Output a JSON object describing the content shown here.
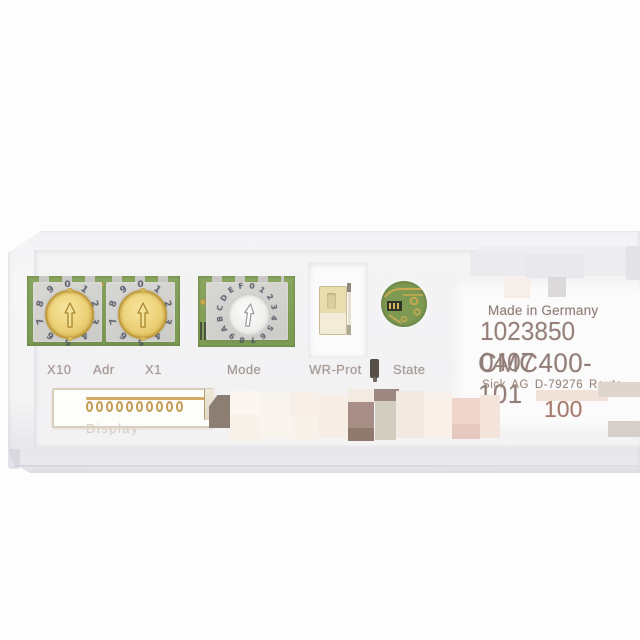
{
  "label": {
    "made_in": "Made in Germany",
    "order_number": "1023850 0407",
    "model": "CMC400-101",
    "manufacturer_line": "Sick AG  D-79276 Reute",
    "partial_bottom": "100"
  },
  "panel_labels": {
    "x10": "X10",
    "adr": "Adr",
    "x1": "X1",
    "mode": "Mode",
    "wr_prot": "WR-Prot",
    "state": "State",
    "display": "Display"
  },
  "switches": {
    "address_tens": {
      "type": "rotary-decimal",
      "digits": [
        "0",
        "1",
        "2",
        "3",
        "4",
        "5",
        "6",
        "7",
        "8",
        "9"
      ]
    },
    "address_ones": {
      "type": "rotary-decimal",
      "digits": [
        "0",
        "1",
        "2",
        "3",
        "4",
        "5",
        "6",
        "7",
        "8",
        "9"
      ]
    },
    "mode": {
      "type": "rotary-hex",
      "digits": [
        "0",
        "1",
        "2",
        "3",
        "4",
        "5",
        "6",
        "7",
        "8",
        "9",
        "A",
        "B",
        "C",
        "D",
        "E",
        "F"
      ]
    },
    "write_protect": {
      "type": "slide-switch"
    }
  },
  "connector": {
    "pins": 10
  },
  "colors": {
    "pcb_green": "#7e9c54",
    "dial_yellow": "#ecd077",
    "gold": "#c9a94f",
    "silkscreen_text": "#a29690",
    "label_text": "#927e78",
    "housing": "#f4f4f5"
  },
  "redactions": [
    {
      "x": 478,
      "y": 246,
      "w": 162,
      "h": 16,
      "c": "#eeeef1"
    },
    {
      "x": 470,
      "y": 252,
      "w": 56,
      "h": 24,
      "c": "#ebebee"
    },
    {
      "x": 526,
      "y": 254,
      "w": 58,
      "h": 24,
      "c": "#e9e9ed"
    },
    {
      "x": 584,
      "y": 250,
      "w": 56,
      "h": 26,
      "c": "#ececef"
    },
    {
      "x": 626,
      "y": 246,
      "w": 14,
      "h": 34,
      "c": "#e3e3e8"
    },
    {
      "x": 504,
      "y": 278,
      "w": 26,
      "h": 20,
      "c": "#f6eee8"
    },
    {
      "x": 548,
      "y": 277,
      "w": 18,
      "h": 20,
      "c": "#dcd9da"
    },
    {
      "x": 209,
      "y": 395,
      "w": 21,
      "h": 33,
      "c": "#8d7e74",
      "clip": "polygon(40% 0,100% 0,100% 100%,0 100%,0 35%)"
    },
    {
      "x": 230,
      "y": 391,
      "w": 30,
      "h": 24,
      "c": "#fbf6f0"
    },
    {
      "x": 230,
      "y": 415,
      "w": 30,
      "h": 26,
      "c": "#f8f1e9"
    },
    {
      "x": 260,
      "y": 393,
      "w": 30,
      "h": 45,
      "c": "#faf4ee"
    },
    {
      "x": 290,
      "y": 391,
      "w": 29,
      "h": 25,
      "c": "#f7efe7"
    },
    {
      "x": 290,
      "y": 416,
      "w": 29,
      "h": 24,
      "c": "#f9f2ea"
    },
    {
      "x": 319,
      "y": 395,
      "w": 29,
      "h": 43,
      "c": "#f6ede5"
    },
    {
      "x": 348,
      "y": 389,
      "w": 27,
      "h": 13,
      "c": "#f3ebe2"
    },
    {
      "x": 348,
      "y": 402,
      "w": 26,
      "h": 26,
      "c": "#a78f87"
    },
    {
      "x": 348,
      "y": 428,
      "w": 26,
      "h": 13,
      "c": "#8f7a6d"
    },
    {
      "x": 374,
      "y": 389,
      "w": 25,
      "h": 12,
      "c": "#9c8880"
    },
    {
      "x": 375,
      "y": 401,
      "w": 21,
      "h": 39,
      "c": "#d3ccc1"
    },
    {
      "x": 396,
      "y": 391,
      "w": 28,
      "h": 47,
      "c": "#f2eae1"
    },
    {
      "x": 424,
      "y": 393,
      "w": 28,
      "h": 45,
      "c": "#f8f0e9"
    },
    {
      "x": 452,
      "y": 398,
      "w": 28,
      "h": 26,
      "c": "#eed6cd"
    },
    {
      "x": 452,
      "y": 424,
      "w": 28,
      "h": 15,
      "c": "#e5c9bf"
    },
    {
      "x": 480,
      "y": 395,
      "w": 20,
      "h": 43,
      "c": "#f4e4dc"
    },
    {
      "x": 536,
      "y": 390,
      "w": 72,
      "h": 11,
      "c": "#f0e2d9"
    },
    {
      "x": 598,
      "y": 382,
      "w": 42,
      "h": 15,
      "c": "#ded5ce"
    },
    {
      "x": 608,
      "y": 421,
      "w": 32,
      "h": 16,
      "c": "#d6cec9"
    }
  ]
}
